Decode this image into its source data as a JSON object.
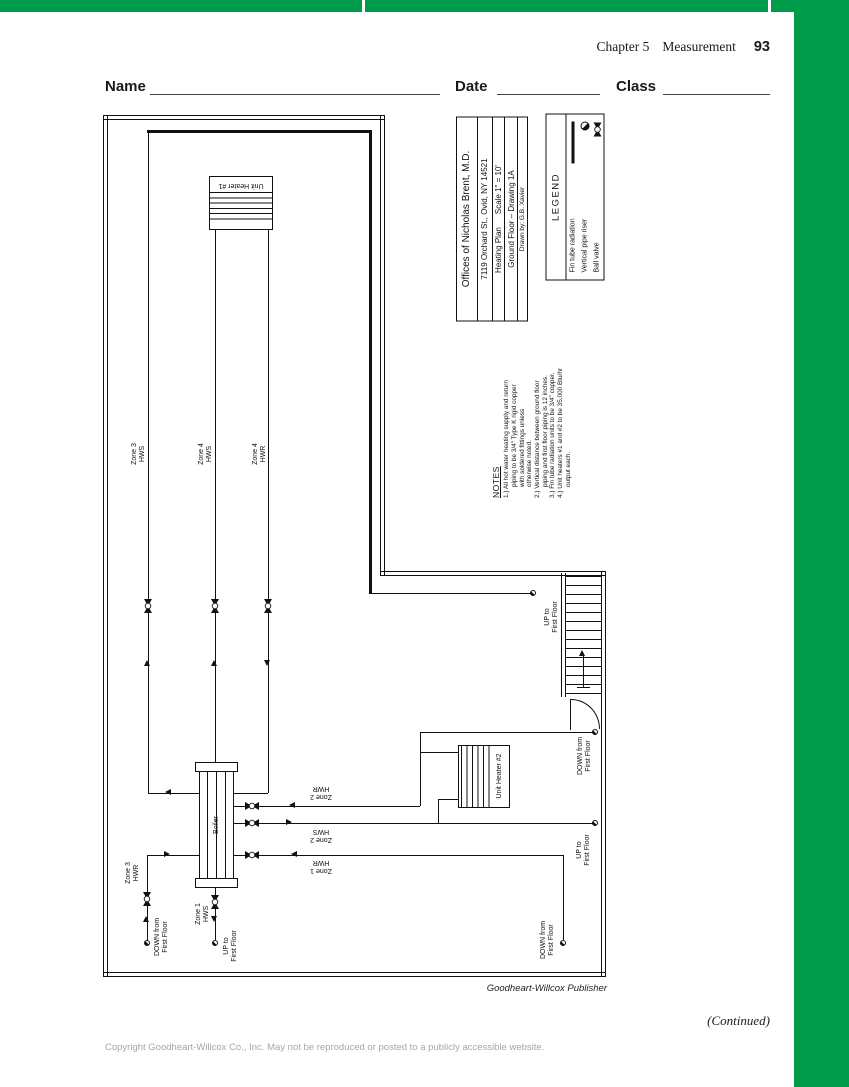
{
  "page": {
    "chapter_header": {
      "chapter": "Chapter 5",
      "title": "Measurement",
      "page_number": "93"
    },
    "worksheet_fields": {
      "name": "Name",
      "date": "Date",
      "class": "Class"
    },
    "footer": {
      "credit": "Goodheart-Willcox Publisher",
      "continued": "(Continued)",
      "copyright": "Copyright Goodheart-Willcox Co., Inc. May not be reproduced or posted to a publicly accessible website."
    },
    "colors": {
      "accent_green": "#009b4a",
      "line": "#111111"
    }
  },
  "title_block": {
    "client": "Offices of Nicholas Brent, M.D.",
    "address": "7119 Orchard St., Ovid, NY 14521",
    "plan_name": "Heating Plan",
    "scale": "Scale 1\" = 10'",
    "sheet": "Ground Floor – Drawing 1A",
    "drawn_by": "Drawn by: G.B. Xavier"
  },
  "legend": {
    "title": "LEGEND",
    "items": [
      {
        "label": "Fin tube radiation",
        "symbol": "fin-tube-thick-line"
      },
      {
        "label": "Vertical pipe riser",
        "symbol": "half-filled-circle"
      },
      {
        "label": "Ball valve",
        "symbol": "ball-valve"
      }
    ]
  },
  "notes": {
    "title": "NOTES",
    "lines": [
      "1.) All hot water heating supply and return",
      "piping to be 3/4\" Type K rigid copper",
      "with soldered fittings unless",
      "otherwise noted.",
      "2.) Vertical distance between ground floor",
      "piping and first floor piping is 12 inches.",
      "3.) Fin tube radiation units to be 3/4\" copper.",
      "4.) Unit heaters #1 and #2 to be 35,000 Btu/hr",
      "output each."
    ]
  },
  "drawing": {
    "equipment": {
      "boiler": "Boiler",
      "unit_heater_1": "Unit Heater #1",
      "unit_heater_2": "Unit Heater #2"
    },
    "zone_labels": {
      "zone3_hws": "Zone 3\nHWS",
      "zone4_hws": "Zone 4\nHWS",
      "zone4_hwr": "Zone 4\nHWR",
      "zone2_hwr": "Zone 2\nHWR",
      "zone2_hws": "Zone 2\nHWS",
      "zone1_hwr": "Zone 1\nHWR",
      "zone3_hwr": "Zone 3\nHWR",
      "zone1_hws": "Zone 1\nHWS"
    },
    "riser_labels": {
      "up": "UP to\nFirst Floor",
      "down": "DOWN from\nFirst Floor"
    }
  }
}
